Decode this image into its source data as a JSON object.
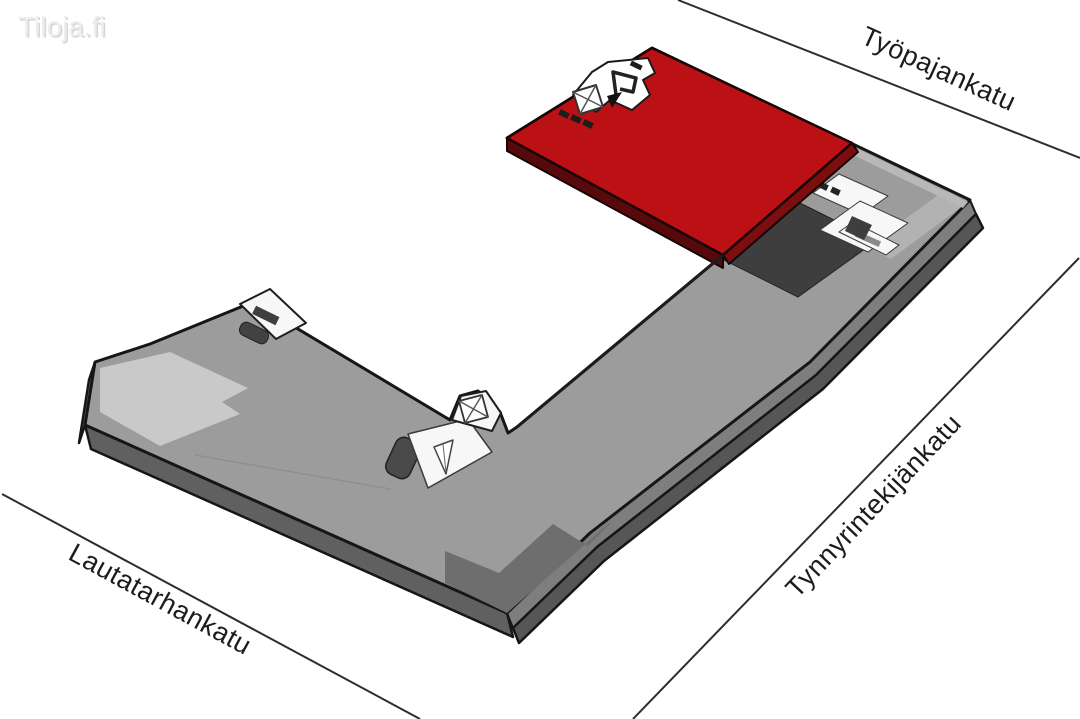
{
  "branding": {
    "logo": "Tiloja.fi"
  },
  "map": {
    "streets": [
      {
        "id": "tyopajankatu",
        "name": "Työpajankatu"
      },
      {
        "id": "tynnyrintekijankatu",
        "name": "Tynnyrintekijänkatu"
      },
      {
        "id": "lautatarhankatu",
        "name": "Lautatarhankatu"
      }
    ]
  },
  "building": {
    "label": "building-floor-plate",
    "colors": {
      "highlight": "#bb1115",
      "highlight_side": "#58090b",
      "floor": "#9c9c9c",
      "floor_light_zone": "#c9c9c9",
      "floor_dark_zone": "#3e3e3e",
      "corner_zone": "#6e6e6e",
      "side_face": "#7e7e7e",
      "side_face_dark": "#565656",
      "outline": "#161616"
    },
    "icons": {
      "elevator": "crossed-box",
      "stairs": "tapered-triangle"
    }
  }
}
